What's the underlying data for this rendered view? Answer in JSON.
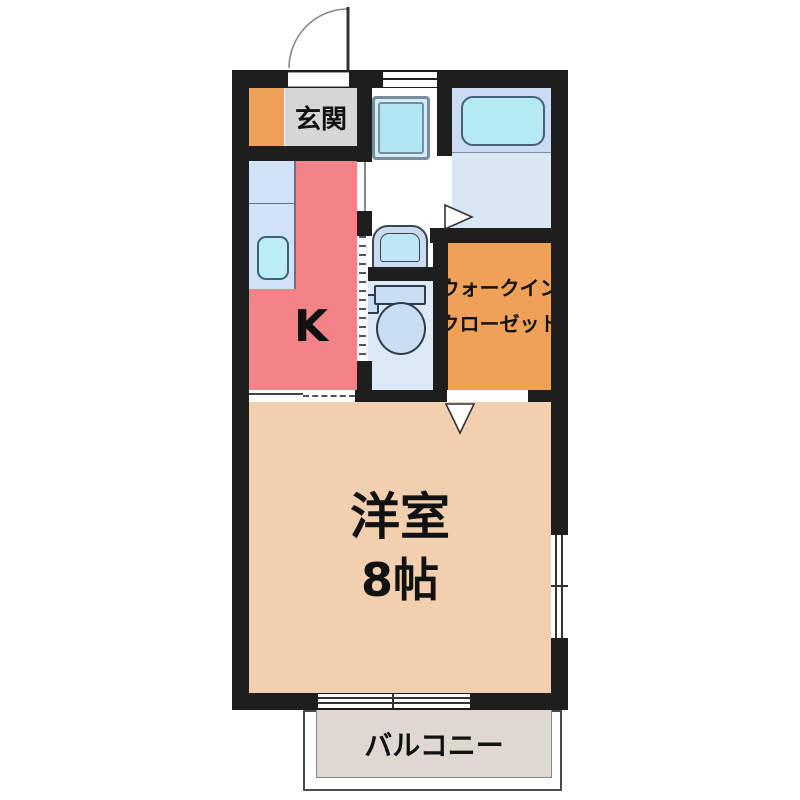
{
  "floorplan": {
    "rooms": {
      "entrance": {
        "label": "玄関"
      },
      "kitchen": {
        "label": "K"
      },
      "western_room": {
        "line1": "洋室",
        "line2": "8帖"
      },
      "walk_in_closet": {
        "line1": "ウォークイン",
        "line2": "クローゼット"
      },
      "balcony": {
        "label": "バルコニー"
      }
    },
    "colors": {
      "wall": "#1e1e1e",
      "entrance_floor": "#d6d6d6",
      "shoe_storage": "#efa257",
      "kitchen": "#f28487",
      "kitchen_counter": "#cfe2f6",
      "kitchen_sink": "#bdeef6",
      "washroom": "#ffffff",
      "washer_pan": "#b2e6f7",
      "bathroom_upper": "#c9dcf3",
      "bathroom_lower": "#d9e6f4",
      "bathtub": "#b6eaf3",
      "toilet_room": "#dce9f7",
      "toilet_fixture": "#c9def2",
      "walk_in_closet": "#efa257",
      "western_room": "#f2cfae",
      "balcony": "#ded8d0"
    }
  }
}
